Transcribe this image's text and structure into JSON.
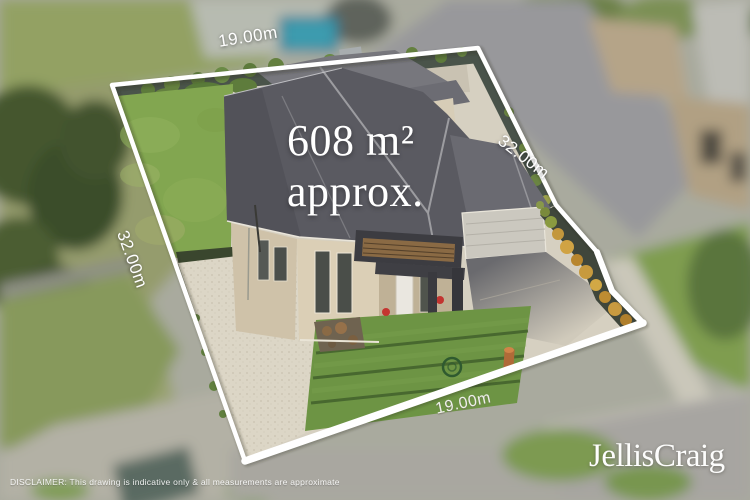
{
  "overlay": {
    "area": {
      "value": "608 m²",
      "qualifier": "approx."
    },
    "dimensions": {
      "top": "19.00m",
      "right": "32.00m",
      "left": "32.00m",
      "bottom": "19.00m"
    },
    "disclaimer": "DISCLAIMER:  This drawing is indicative only & all measurements are approximate",
    "brand": "JellisCraig",
    "colors": {
      "boundary_line": "#ffffff",
      "label_text": "#ffffff"
    }
  },
  "scene": {
    "palette": {
      "backyard_lawn": "#82a650",
      "front_lawn": "#6d9444",
      "roof_main": "#5a5a61",
      "roof_rear": "#77777d",
      "walls_front": "#dbcfb6",
      "walls_left": "#cfc2a9",
      "gravel": "#dcd6c6",
      "concrete": "#d6d0c1",
      "pool": "#2b7f95",
      "trees": "#44562f",
      "fence": "#4a544a",
      "garden_bed": "#3f463b",
      "shrub_orange": "#c89a40",
      "road": "#a7a5a1",
      "neighbor_roof": "#98989b",
      "shed": "#5a6a62"
    }
  }
}
